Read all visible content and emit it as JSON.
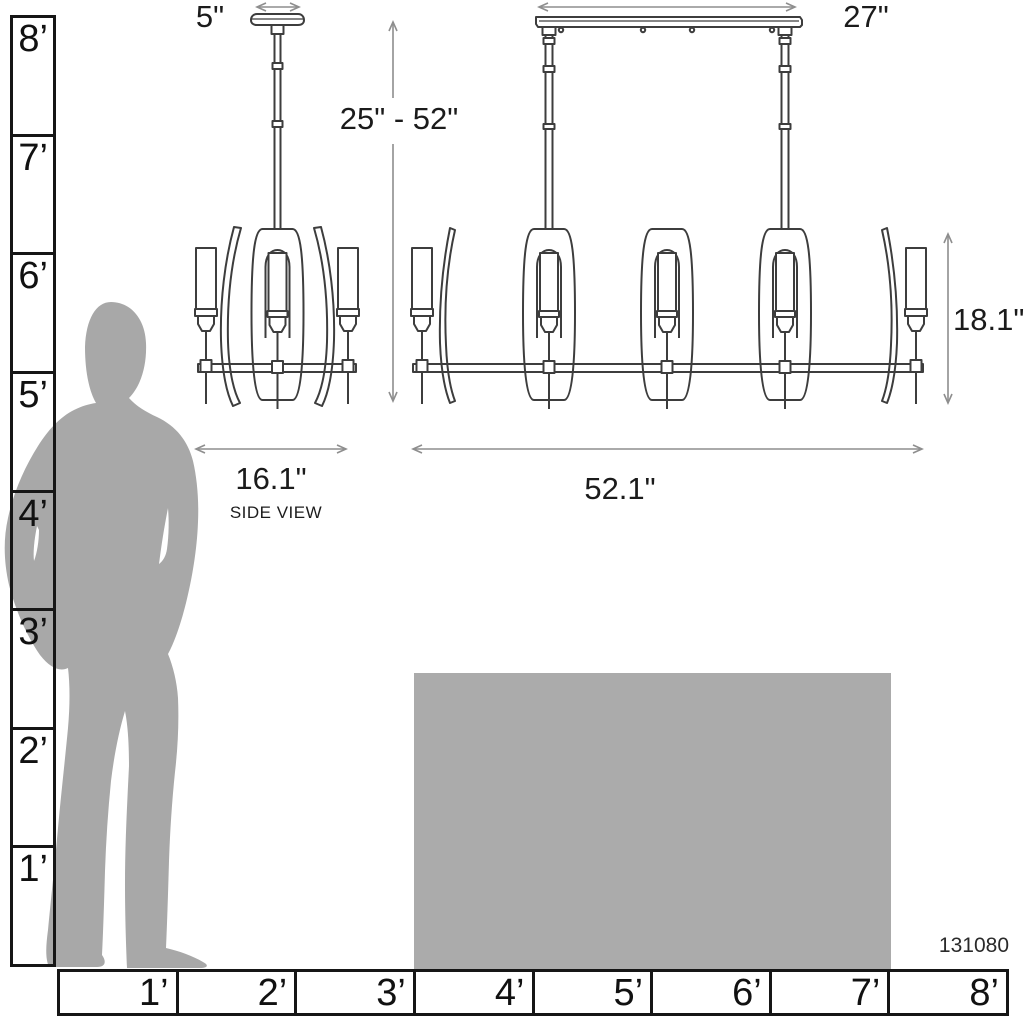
{
  "product": {
    "id": "131080"
  },
  "side_view": {
    "canopy_width": "5\"",
    "fixture_width": "16.1\"",
    "caption": "SIDE VIEW"
  },
  "front_view": {
    "rail_width": "27\"",
    "suspension_range": "25\" - 52\"",
    "fixture_height": "18.1\"",
    "fixture_width": "52.1\""
  },
  "rulers": {
    "vertical": {
      "labels": [
        "8’",
        "7’",
        "6’",
        "5’",
        "4’",
        "3’",
        "2’",
        "1’"
      ]
    },
    "horizontal": {
      "labels": [
        "1’",
        "2’",
        "3’",
        "4’",
        "5’",
        "6’",
        "7’",
        "8’"
      ]
    }
  },
  "colors": {
    "silhouette": "#a8a8a8",
    "table": "#ababab",
    "drawing_line": "#3d3d3d",
    "dimension_line": "#8e8e8e",
    "ruler_line": "#161616",
    "text": "#1b1b1b"
  }
}
